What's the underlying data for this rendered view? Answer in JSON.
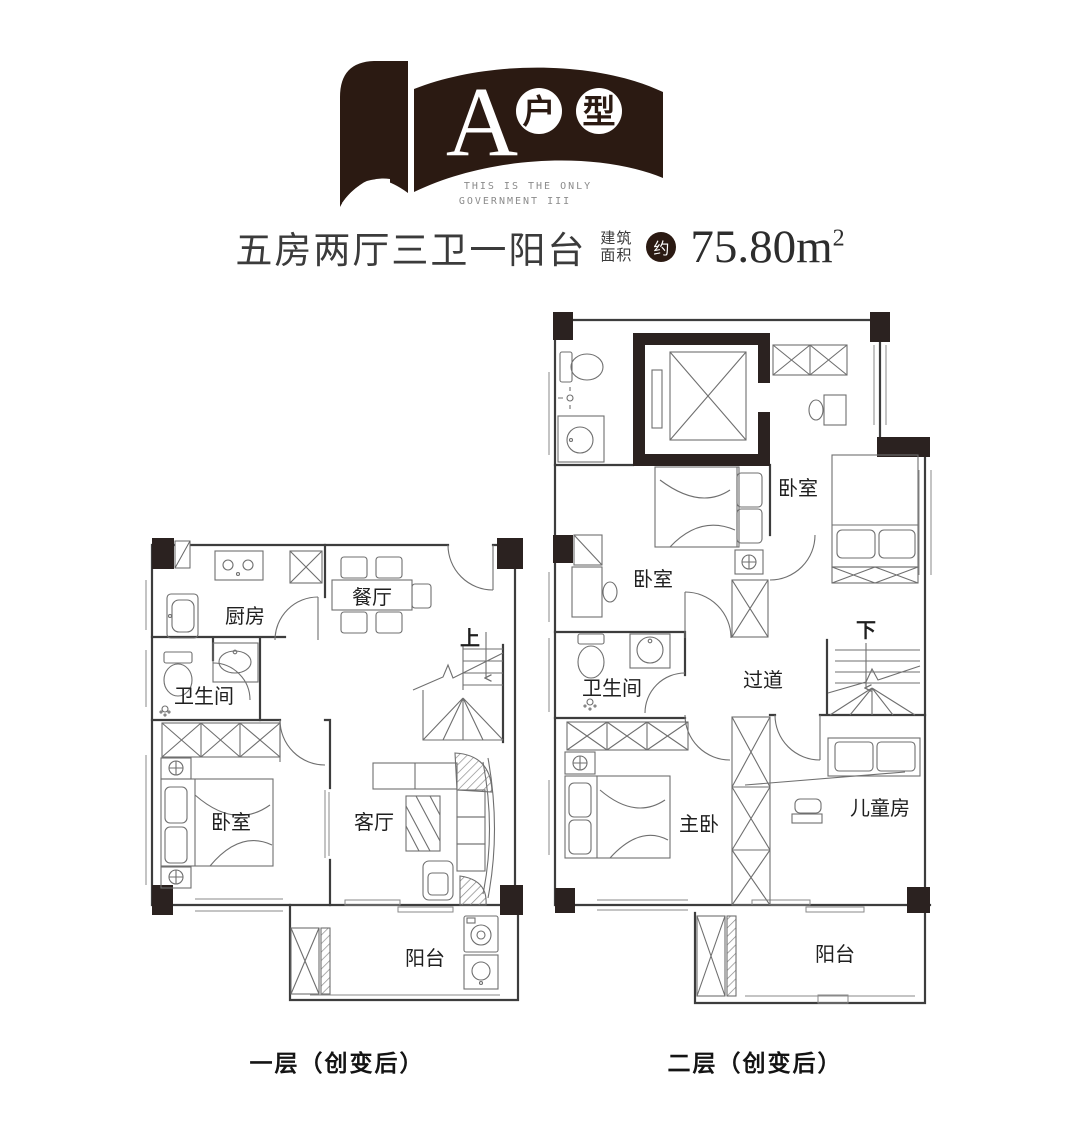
{
  "colors": {
    "brand_dark": "#2b1a12",
    "line": "#3d3d3d",
    "furniture_line": "#6f6f6f",
    "label_text": "#1f1f1f"
  },
  "logo": {
    "letter": "A",
    "circle1": "户",
    "circle2": "型",
    "tagline_line1": "THIS IS THE ONLY",
    "tagline_line2": "GOVERNMENT III"
  },
  "subtitle": {
    "layout_text": "五房两厅三卫一阳台",
    "area_label_top": "建筑",
    "area_label_bottom": "面积",
    "approx": "约",
    "area_value": "75.80m",
    "area_sup": "2"
  },
  "floor1": {
    "caption": "一层（创变后）",
    "rooms": {
      "kitchen": "厨房",
      "dining": "餐厅",
      "bath": "卫生间",
      "bedroom": "卧室",
      "living": "客厅",
      "balcony": "阳台",
      "stairs_up": "上"
    }
  },
  "floor2": {
    "caption": "二层（创变后）",
    "rooms": {
      "bedroom_left": "卧室",
      "bedroom_right": "卧室",
      "bath": "卫生间",
      "hallway": "过道",
      "master": "主卧",
      "kids": "儿童房",
      "balcony": "阳台",
      "stairs_down": "下"
    }
  }
}
